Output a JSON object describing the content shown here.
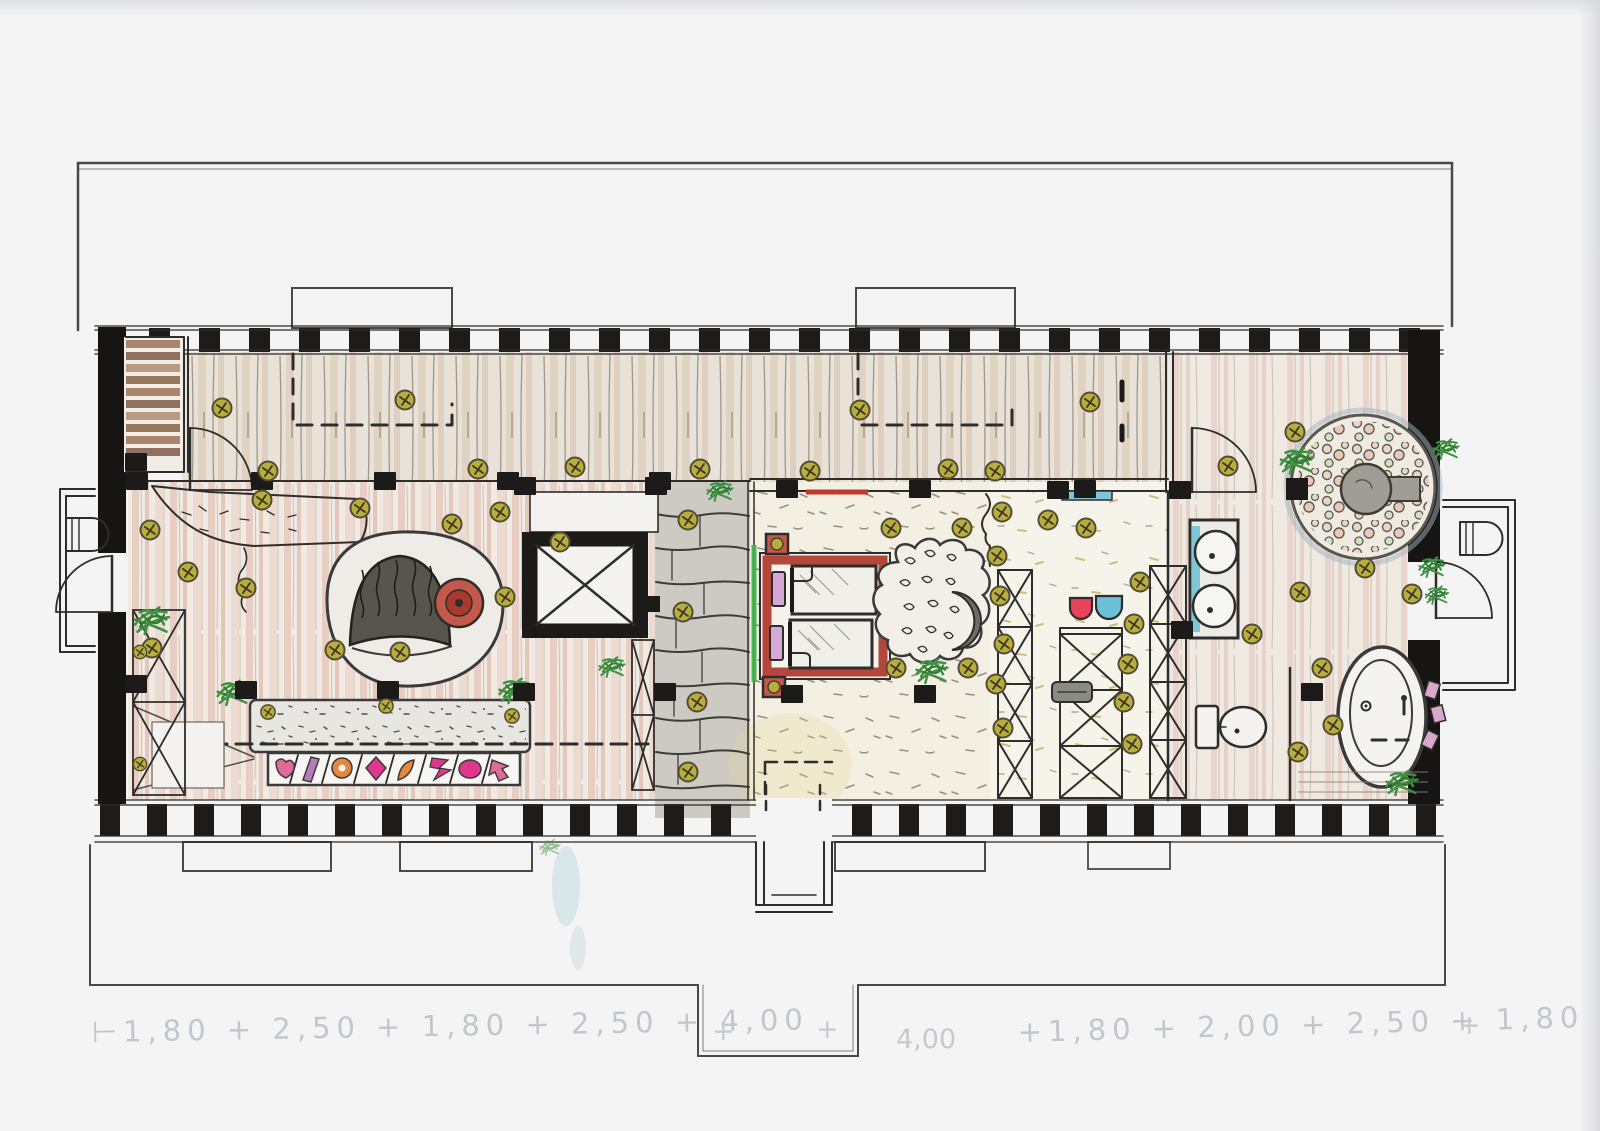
{
  "document": {
    "kind": "hand-drawn attic floor plan, pencil and colored pencil on scanned paper",
    "paper_color": "#f4f4f5"
  },
  "fixtures": [
    "staircase-icon",
    "elevator-icon",
    "double-bed-icon",
    "round-sofa-icon",
    "bench-sofa-icon",
    "wardrobe-x-icon",
    "round-shower-icon",
    "bathtub-icon",
    "toilet-icon",
    "vanity-sinks-icon",
    "ceiling-light-icon",
    "plant-icon",
    "door-swing-icon"
  ],
  "palette": {
    "ink": "#2e2d2b",
    "wall_black": "#1c1b19",
    "stair_wood": "#9b7c6b",
    "bed_red": "#b5463c",
    "table_red": "#c4584a",
    "accent_green": "#3bb54a",
    "chair_red": "#e8435a",
    "chair_blue": "#6cc0d8",
    "teal": "#6fc3d4",
    "shelf_blue": "#7fc4d8",
    "light_olive": "#b9ad3c",
    "plant_green": "#3f8f45",
    "mosaic_pink": "#e06a9a",
    "mosaic_orange": "#e8863c",
    "mosaic_magenta": "#e0368c",
    "mosaic_purple": "#b87ab8",
    "stone_grey": "#cdc9c3",
    "pencil_grey": "#c3c6ca"
  },
  "annotations": {
    "dim_left": "⊢1,80 + 2,50 + 1,80 + 2,50 + 4,00",
    "plus_mark": "+",
    "dim_right_value": "4,00",
    "dim_right": "+1,80 + 2,00 + 2,50 + 1,80",
    "dim_right_end": "+"
  }
}
